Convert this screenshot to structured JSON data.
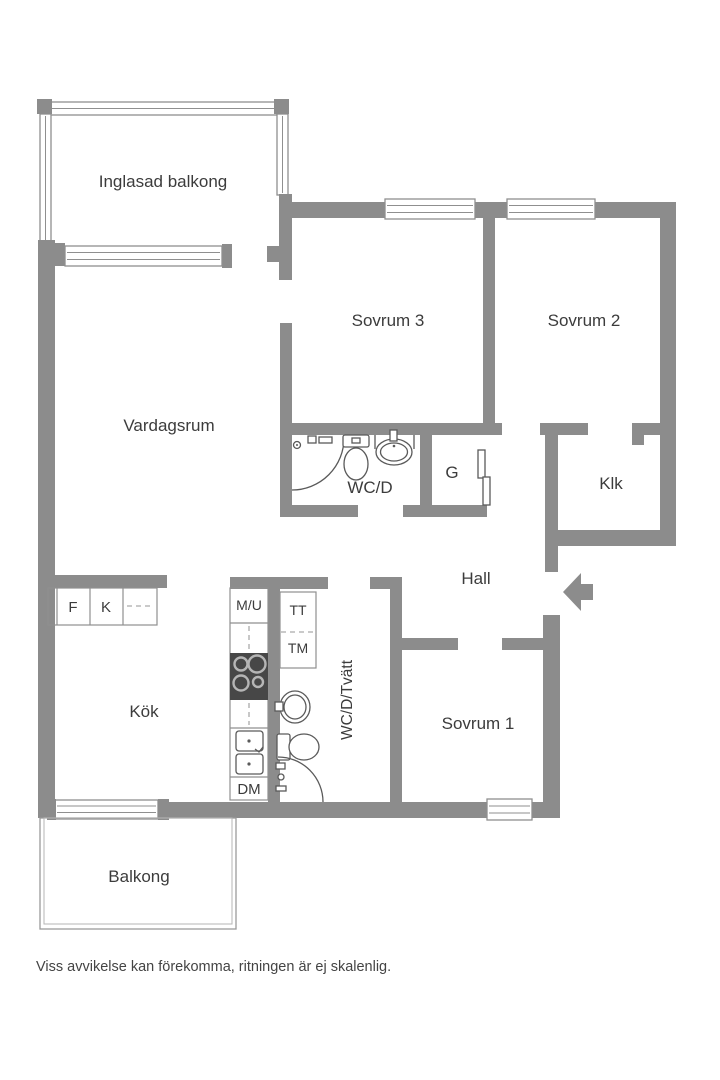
{
  "palette": {
    "wall": "#8c8c8c",
    "line": "#5a5a5a",
    "winline": "#8f8f8f",
    "dash": "#aaaaaa",
    "text": "#3c3c3c",
    "stove": "#474747",
    "note": "#444444"
  },
  "rooms": {
    "inglasad_balkong": {
      "label": "Inglasad balkong"
    },
    "vardagsrum": {
      "label": "Vardagsrum"
    },
    "sovrum_3": {
      "label": "Sovrum 3"
    },
    "sovrum_2": {
      "label": "Sovrum 2"
    },
    "wc_d": {
      "label": "WC/D"
    },
    "g": {
      "label": "G"
    },
    "klk": {
      "label": "Klk"
    },
    "hall": {
      "label": "Hall"
    },
    "kok": {
      "label": "Kök"
    },
    "wc_d_tvatt": {
      "label": "WC/D/Tvätt"
    },
    "sovrum_1": {
      "label": "Sovrum 1"
    },
    "balkong": {
      "label": "Balkong"
    }
  },
  "fixtures": {
    "fridge": "F",
    "freezer": "K",
    "micro_oven": "M/U",
    "tumble_dryer": "TT",
    "washing_machine": "TM",
    "dishwasher": "DM"
  },
  "footer": {
    "disclaimer": "Viss avvikelse kan förekomma, ritningen är ej skalenlig."
  }
}
